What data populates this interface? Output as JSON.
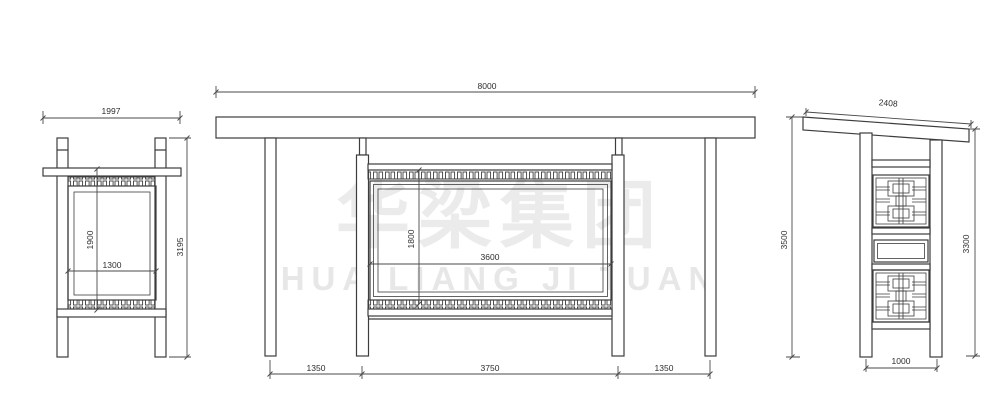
{
  "watermark": {
    "cn": "华梁集团",
    "en": "HUA LIANG JI TUAN",
    "color_cn": "#ebebeb",
    "color_en": "#e7e7e7"
  },
  "drawing": {
    "line_color": "#3d3d3d",
    "background": "#ffffff"
  },
  "views": {
    "side_left": {
      "dim_overall_width": "1997",
      "dim_panel_height": "1900",
      "dim_panel_width": "1300",
      "dim_overall_height": "3195"
    },
    "front": {
      "dim_roof_width": "8000",
      "dim_panel_height": "1800",
      "dim_panel_width": "3600",
      "dim_bay_left": "1350",
      "dim_bay_center": "3750",
      "dim_bay_right": "1350"
    },
    "side_right": {
      "dim_roof_slope_width": "2408",
      "dim_height_left": "3500",
      "dim_height_right": "3300",
      "dim_base_width": "1000"
    }
  }
}
